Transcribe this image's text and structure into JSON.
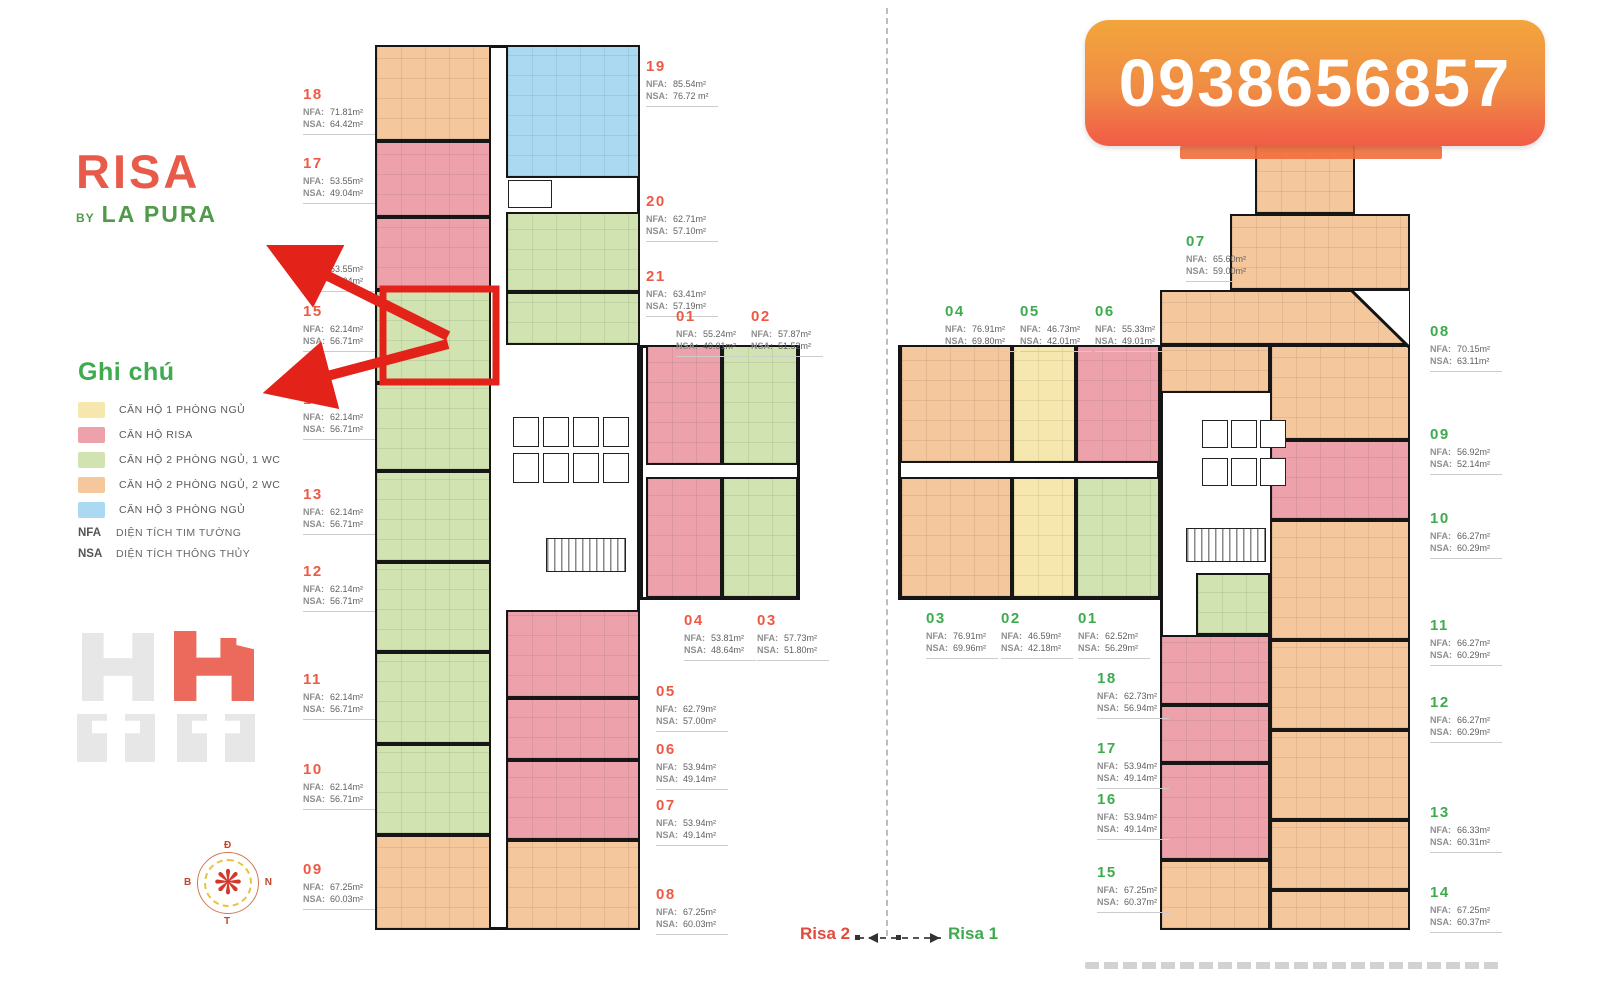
{
  "logo": {
    "word": "RISA",
    "by": "BY",
    "brand": "LA PURA"
  },
  "phone_banner": {
    "number": "0938656857",
    "gradient_top": "#F2A53C",
    "gradient_bottom": "#F15B47"
  },
  "legend": {
    "title": "Ghi chú",
    "items": [
      {
        "key": "yellow",
        "color": "#F5E7AE",
        "label": "CĂN HỘ 1 PHÒNG NGỦ"
      },
      {
        "key": "pink",
        "color": "#EDA2AB",
        "label": "CĂN HỘ RISA"
      },
      {
        "key": "green",
        "color": "#D0E3B1",
        "label": "CĂN HỘ 2 PHÒNG NGỦ, 1 WC"
      },
      {
        "key": "orange",
        "color": "#F5C79D",
        "label": "CĂN HỘ 2 PHÒNG NGỦ, 2 WC"
      },
      {
        "key": "blue",
        "color": "#ABD9F1",
        "label": "CĂN HỘ 3 PHÒNG NGỦ"
      }
    ],
    "abbreviations": [
      {
        "abbr": "NFA",
        "meaning": "DIỆN TÍCH TIM TƯỜNG"
      },
      {
        "abbr": "NSA",
        "meaning": "DIỆN TÍCH THÔNG THỦY"
      }
    ]
  },
  "labels": {
    "nfa": "NFA:",
    "nsa": "NSA:"
  },
  "risa2": {
    "name": "Risa 2",
    "number_color": "#EE5946",
    "units": [
      {
        "id": "18",
        "nfa": "71.81m²",
        "nsa": "64.42m²"
      },
      {
        "id": "17",
        "nfa": "53.55m²",
        "nsa": "49.04m²"
      },
      {
        "id": "16",
        "nfa": "53.55m²",
        "nsa": "49.04m²"
      },
      {
        "id": "15",
        "nfa": "62.14m²",
        "nsa": "56.71m²"
      },
      {
        "id": "14",
        "nfa": "62.14m²",
        "nsa": "56.71m²"
      },
      {
        "id": "13",
        "nfa": "62.14m²",
        "nsa": "56.71m²"
      },
      {
        "id": "12",
        "nfa": "62.14m²",
        "nsa": "56.71m²"
      },
      {
        "id": "11",
        "nfa": "62.14m²",
        "nsa": "56.71m²"
      },
      {
        "id": "10",
        "nfa": "62.14m²",
        "nsa": "56.71m²"
      },
      {
        "id": "09",
        "nfa": "67.25m²",
        "nsa": "60.03m²"
      },
      {
        "id": "19",
        "nfa": "85.54m²",
        "nsa": "76.72 m²"
      },
      {
        "id": "20",
        "nfa": "62.71m²",
        "nsa": "57.10m²"
      },
      {
        "id": "21",
        "nfa": "63.41m²",
        "nsa": "57.19m²"
      },
      {
        "id": "01",
        "nfa": "55.24m²",
        "nsa": "49.01m²"
      },
      {
        "id": "02",
        "nfa": "57.87m²",
        "nsa": "51.52m²"
      },
      {
        "id": "04",
        "nfa": "53.81m²",
        "nsa": "48.64m²"
      },
      {
        "id": "03",
        "nfa": "57.73m²",
        "nsa": "51.80m²"
      },
      {
        "id": "05",
        "nfa": "62.79m²",
        "nsa": "57.00m²"
      },
      {
        "id": "06",
        "nfa": "53.94m²",
        "nsa": "49.14m²"
      },
      {
        "id": "07",
        "nfa": "53.94m²",
        "nsa": "49.14m²"
      },
      {
        "id": "08",
        "nfa": "67.25m²",
        "nsa": "60.03m²"
      }
    ]
  },
  "risa1": {
    "name": "Risa 1",
    "number_color": "#3DAB4E",
    "units": [
      {
        "id": "07",
        "nfa": "65.60m²",
        "nsa": "59.00m²"
      },
      {
        "id": "04",
        "nfa": "76.91m²",
        "nsa": "69.80m²"
      },
      {
        "id": "05",
        "nfa": "46.73m²",
        "nsa": "42.01m²"
      },
      {
        "id": "06",
        "nfa": "55.33m²",
        "nsa": "49.01m²"
      },
      {
        "id": "08",
        "nfa": "70.15m²",
        "nsa": "63.11m²"
      },
      {
        "id": "09",
        "nfa": "56.92m²",
        "nsa": "52.14m²"
      },
      {
        "id": "10",
        "nfa": "66.27m²",
        "nsa": "60.29m²"
      },
      {
        "id": "11",
        "nfa": "66.27m²",
        "nsa": "60.29m²"
      },
      {
        "id": "12",
        "nfa": "66.27m²",
        "nsa": "60.29m²"
      },
      {
        "id": "13",
        "nfa": "66.33m²",
        "nsa": "60.31m²"
      },
      {
        "id": "14",
        "nfa": "67.25m²",
        "nsa": "60.37m²"
      },
      {
        "id": "03",
        "nfa": "76.91m²",
        "nsa": "69.96m²"
      },
      {
        "id": "02",
        "nfa": "46.59m²",
        "nsa": "42.18m²"
      },
      {
        "id": "01",
        "nfa": "62.52m²",
        "nsa": "56.29m²"
      },
      {
        "id": "18",
        "nfa": "62.73m²",
        "nsa": "56.94m²"
      },
      {
        "id": "17",
        "nfa": "53.94m²",
        "nsa": "49.14m²"
      },
      {
        "id": "16",
        "nfa": "53.94m²",
        "nsa": "49.14m²"
      },
      {
        "id": "15",
        "nfa": "67.25m²",
        "nsa": "60.37m²"
      }
    ]
  },
  "footer": {
    "left": "Risa 2",
    "right": "Risa 1"
  },
  "compass": {
    "top": "Đ",
    "right": "N",
    "bottom": "T",
    "left": "B"
  },
  "highlight": {
    "unit": "15",
    "color": "#E3231A"
  }
}
